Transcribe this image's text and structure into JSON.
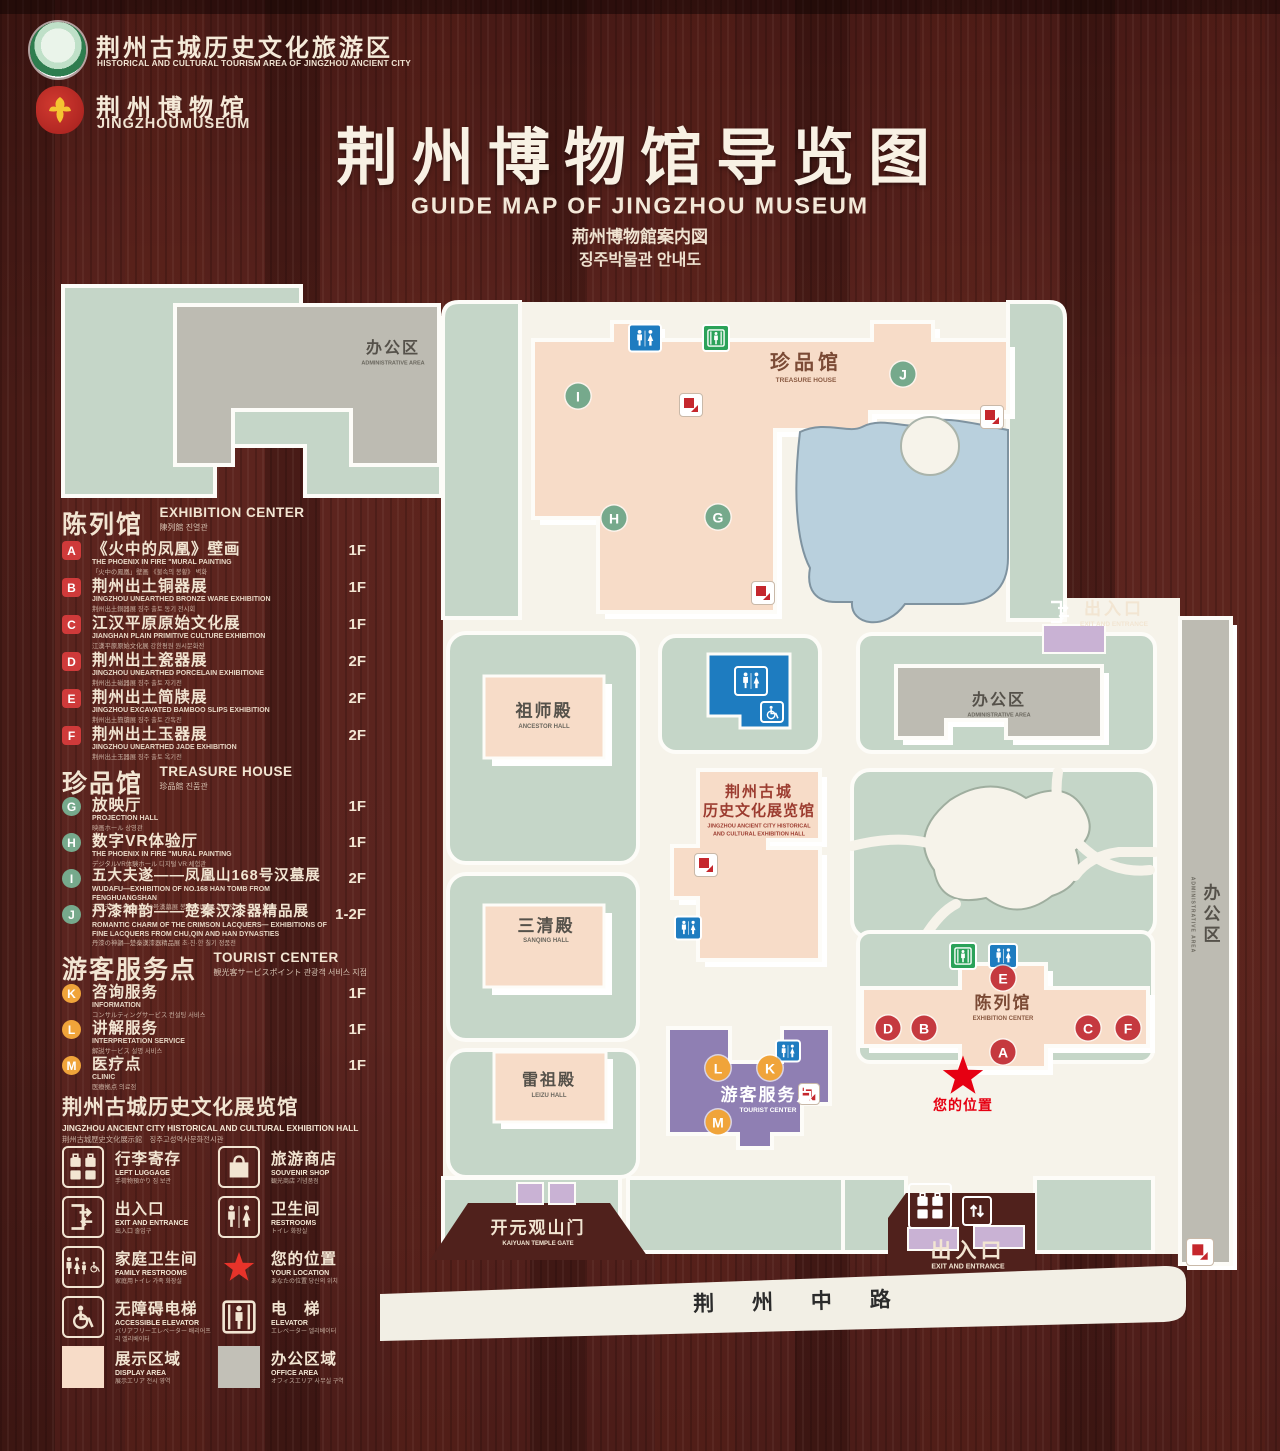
{
  "header": {
    "logo1_cn": "荆州古城历史文化旅游区",
    "logo1_en": "HISTORICAL AND CULTURAL TOURISM AREA OF JINGZHOU ANCIENT CITY",
    "logo2_cn": "荆州博物馆",
    "logo2_en": "JINGZHOUMUSEUM",
    "title": "荆州博物馆导览图",
    "subtitle_en": "GUIDE MAP OF JINGZHOU MUSEUM",
    "subtitle_jp": "荊州博物館案内図",
    "subtitle_kr": "징주박물관 안내도"
  },
  "legend": {
    "sections": [
      {
        "title_cn": "陈列馆",
        "title_en": "EXHIBITION CENTER",
        "title_sub": "陳列館  진열관",
        "items": [
          {
            "letter": "A",
            "cn": "《火中的凤凰》壁画",
            "en": "THE PHOENIX IN FIRE \"MURAL PAINTING",
            "sub": "「火中の鳳凰」壁画 《불속의 봉황》 벽화",
            "floor": "1F"
          },
          {
            "letter": "B",
            "cn": "荆州出土铜器展",
            "en": "JINGZHOU UNEARTHED BRONZE WARE EXHIBITION",
            "sub": "荆州出土銅器展  징주 출토 동기 전시회",
            "floor": "1F"
          },
          {
            "letter": "C",
            "cn": "江汉平原原始文化展",
            "en": "JIANGHAN PLAIN PRIMITIVE CULTURE EXHIBITION",
            "sub": "江漢平原原始文化展  강한평원 원시문화전",
            "floor": "1F"
          },
          {
            "letter": "D",
            "cn": "荆州出土瓷器展",
            "en": "JINGZHOU UNEARTHED PORCELAIN EXHIBITIONE",
            "sub": "荆州出土磁器展  징주 출토 자기전",
            "floor": "2F"
          },
          {
            "letter": "E",
            "cn": "荆州出土简牍展",
            "en": "JINGZHOU EXCAVATED BAMBOO SLIPS EXHIBITION",
            "sub": "荆州出土簡牘展  징주 출토 간독전",
            "floor": "2F"
          },
          {
            "letter": "F",
            "cn": "荆州出土玉器展",
            "en": "JINGZHOU UNEARTHED JADE EXHIBITION",
            "sub": "荆州出土玉器展  징주 출토 옥기전",
            "floor": "2F"
          }
        ]
      },
      {
        "title_cn": "珍品馆",
        "title_en": "TREASURE HOUSE",
        "title_sub": "珍品館  진품관",
        "items": [
          {
            "letter": "G",
            "cn": "放映厅",
            "en": "PROJECTION HALL",
            "sub": "映画ホール  상영관",
            "floor": "1F"
          },
          {
            "letter": "H",
            "cn": "数字VR体验厅",
            "en": "THE PHOENIX IN FIRE \"MURAL PAINTING",
            "sub": "デジタルVR体験ホール  디지털 VR 체험관",
            "floor": "1F"
          },
          {
            "letter": "I",
            "cn": "五大夫遂——凤凰山168号汉墓展",
            "en": "WUDAFU—EXHIBITION OF NO.168 HAN TOMB FROM FENGHUANGSHAN",
            "sub": "五大夫遂—鳳凰山168号漢墓展  봉황산 168호 한묘전",
            "floor": "2F"
          },
          {
            "letter": "J",
            "cn": "丹漆神韵——楚秦汉漆器精品展",
            "en": "ROMANTIC CHARM OF THE CRIMSON LACQUERS— EXHIBITIONS OF FINE LACQUERS FROM CHU,QIN AND HAN DYNASTIES",
            "sub": "丹漆の神韻—楚秦漢漆器精品展  초·진·한 칠기 정품전",
            "floor": "1-2F"
          }
        ]
      },
      {
        "title_cn": "游客服务点",
        "title_en": "TOURIST CENTER",
        "title_sub": "観光客サービスポイント  관광객 서비스 지점",
        "items": [
          {
            "letter": "K",
            "cn": "咨询服务",
            "en": "INFORMATION",
            "sub": "コンサルティングサービス  컨설팅 서비스",
            "floor": "1F"
          },
          {
            "letter": "L",
            "cn": "讲解服务",
            "en": "INTERPRETATION SERVICE",
            "sub": "解説サービス  설명 서비스",
            "floor": "1F"
          },
          {
            "letter": "M",
            "cn": "医疗点",
            "en": "CLINIC",
            "sub": "医療拠点  의료점",
            "floor": "1F"
          }
        ]
      }
    ],
    "hall_note": {
      "cn": "荆州古城历史文化展览馆",
      "en": "JINGZHOU ANCIENT CITY HISTORICAL AND CULTURAL EXHIBITION HALL",
      "sub": "荆州古城歴史文化展示館　징주고성역사문화전시관"
    },
    "icons": [
      {
        "cn": "行李寄存",
        "en": "LEFT LUGGAGE",
        "sub": "手荷物預かり  짐 보관"
      },
      {
        "cn": "旅游商店",
        "en": "SOUVENIR SHOP",
        "sub": "観光商店  기념품점"
      },
      {
        "cn": "出入口",
        "en": "EXIT AND ENTRANCE",
        "sub": "出入口  출입구"
      },
      {
        "cn": "卫生间",
        "en": "RESTROOMS",
        "sub": "トイレ  화장실"
      },
      {
        "cn": "家庭卫生间",
        "en": "FAMILY RESTROOMS",
        "sub": "家庭用トイレ  가족 화장실"
      },
      {
        "cn": "您的位置",
        "en": "YOUR LOCATION",
        "sub": "あなたの位置  당신의 위치"
      },
      {
        "cn": "无障碍电梯",
        "en": "ACCESSIBLE ELEVATOR",
        "sub": "バリアフリーエレベーター  배리어프리 엘리베이터"
      },
      {
        "cn": "电　梯",
        "en": "ELEVATOR",
        "sub": "エレベーター  엘리베이터"
      },
      {
        "cn": "展示区域",
        "en": "DISPLAY AREA",
        "sub": "展示エリア  전시 영역"
      },
      {
        "cn": "办公区域",
        "en": "OFFICE AREA",
        "sub": "オフィスエリア  사무실 구역"
      }
    ]
  },
  "map": {
    "labels": {
      "admin_top_cn": "办公区",
      "admin_top_en": "ADMINISTRATIVE AREA",
      "treasure_cn": "珍品馆",
      "treasure_en": "TREASURE HOUSE",
      "ancestor_cn": "祖师殿",
      "ancestor_en": "ANCESTOR HALL",
      "sanqing_cn": "三清殿",
      "sanqing_en": "SANQING HALL",
      "leizu_cn": "雷祖殿",
      "leizu_en": "LEIZU HALL",
      "hall_cn1": "荆州古城",
      "hall_cn2": "历史文化展览馆",
      "hall_en1": "JINGZHOU ANCIENT CITY HISTORICAL",
      "hall_en2": "AND CULTURAL EXHIBITION HALL",
      "admin_right_cn": "办公区",
      "admin_right_en": "ADMINISTRATIVE AREA",
      "exhcenter_cn": "陈列馆",
      "exhcenter_en": "EXHIBITION CENTER",
      "tourist_cn": "游客服务点",
      "tourist_en": "TOURIST CENTER",
      "your_location": "您的位置",
      "gate_cn": "开元观山门",
      "gate_en": "KAIYUAN TEMPLE GATE",
      "exit_top_cn": "出入口",
      "exit_top_en": "EXIT AND ENTRANCE",
      "exit_bottom_cn": "出入口",
      "exit_bottom_en": "EXIT AND ENTRANCE",
      "road": "荆 州 中 路",
      "strip_cn": "办公区",
      "strip_en": "ADMINISTRATIVE AREA"
    },
    "markers": {
      "A": "A",
      "B": "B",
      "C": "C",
      "D": "D",
      "E": "E",
      "F": "F",
      "G": "G",
      "H": "H",
      "I": "I",
      "J": "J",
      "K": "K",
      "L": "L",
      "M": "M"
    }
  },
  "colors": {
    "wood": "#5a241f",
    "display_area": "#f7dcc8",
    "office_area": "#bdbbb2",
    "mint": "#c5d6c8",
    "lake": "#b9d0dd",
    "tourist_purple": "#8f7fb3",
    "gate_purple": "#c9b2d4",
    "wc_blue": "#1e7cc0",
    "elevator_green": "#2ba259",
    "escalator_red": "#c5272d",
    "marker_green": "#76a98c",
    "marker_red": "#c5393f",
    "marker_orange": "#f0a43a",
    "star_red": "#e60012"
  }
}
